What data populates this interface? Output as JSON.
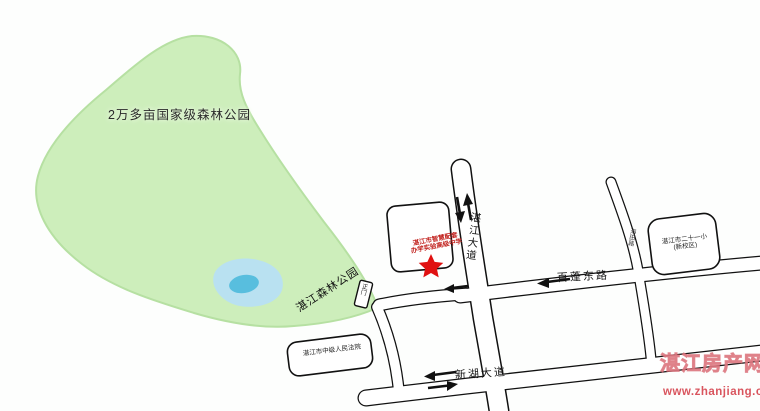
{
  "map": {
    "park": {
      "name": "2万多亩国家级森林公园",
      "label": "湛江森林公园",
      "gate_label": "正门"
    },
    "poi": {
      "star_caption_line1": "湛江市智慧配套",
      "star_caption_line2": "办学实验高级中学",
      "court_label": "湛江市中级人民法院",
      "school_label_line1": "湛江市二十一小",
      "school_label_line2": "(新校区)"
    },
    "roads": {
      "zhanjiang_avenue": "湛江大道",
      "baipeng_east_road": "百蓬东路",
      "xinhu_avenue": "新湖大道",
      "haitian_road": "海田路"
    },
    "watermark": {
      "site_name": "湛江房产网",
      "site_url": "www.zhanjiang.cc"
    },
    "icons": {
      "location_star": "★",
      "arrow_up": "↑",
      "arrow_down": "↓",
      "arrow_left": "←",
      "arrow_right": "→"
    },
    "colors": {
      "park_green": "#cdeebb",
      "park_edge": "#b6e0a2",
      "lake_blue": "#b9e1f1",
      "lake_core": "#58bede",
      "star_red": "#e01111",
      "caption_red": "#c2231f",
      "watermark_pink": "#d35460"
    }
  }
}
